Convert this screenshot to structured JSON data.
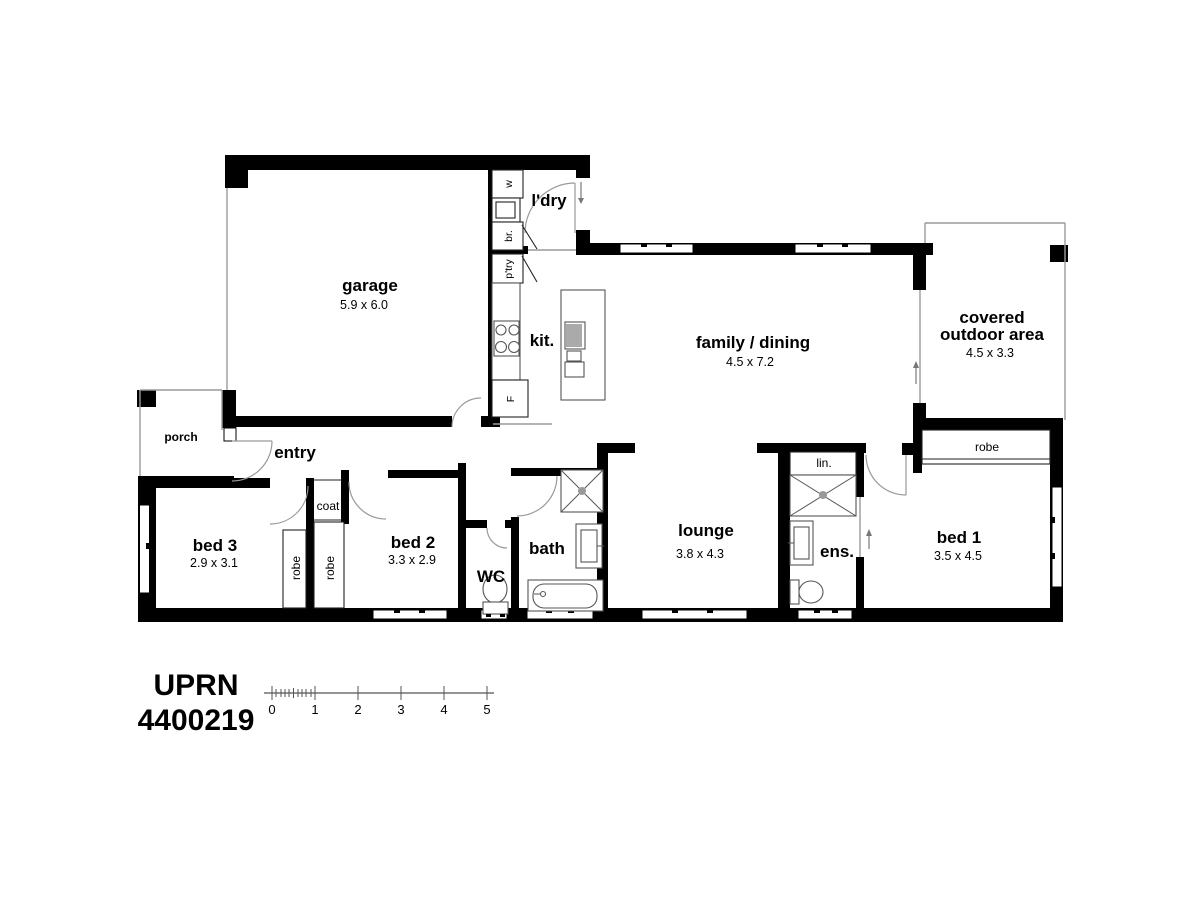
{
  "colors": {
    "ink": "#000000",
    "door_line": "#9a9a9a",
    "fixture_line": "#555555",
    "background": "#ffffff"
  },
  "rooms": {
    "garage": {
      "name": "garage",
      "dim": "5.9 x 6.0"
    },
    "laundry": {
      "name": "l'dry"
    },
    "kitchen": {
      "name": "kit."
    },
    "family_dining": {
      "name": "family / dining",
      "dim": "4.5 x 7.2"
    },
    "covered_outdoor": {
      "line1": "covered",
      "line2": "outdoor area",
      "dim": "4.5 x 3.3"
    },
    "porch": {
      "name": "porch"
    },
    "entry": {
      "name": "entry"
    },
    "bed1": {
      "name": "bed 1",
      "dim": "3.5 x 4.5"
    },
    "bed2": {
      "name": "bed 2",
      "dim": "3.3 x 2.9"
    },
    "bed3": {
      "name": "bed 3",
      "dim": "2.9 x 3.1"
    },
    "lounge": {
      "name": "lounge",
      "dim": "3.8 x 4.3"
    },
    "bath": {
      "name": "bath"
    },
    "wc": {
      "name": "WC"
    },
    "ensuite": {
      "name": "ens."
    },
    "linen": {
      "name": "lin."
    },
    "coat": {
      "name": "coat"
    },
    "robe_bed1": {
      "name": "robe"
    },
    "robe_bed2": {
      "name": "robe"
    },
    "robe_bed3": {
      "name": "robe"
    }
  },
  "appliances": {
    "washer": "w",
    "broom": "br.",
    "pantry": "p'try",
    "fridge": "F"
  },
  "title": {
    "line1": "UPRN",
    "line2": "4400219"
  },
  "scale_bar": {
    "ticks": [
      "0",
      "1",
      "2",
      "3",
      "4",
      "5"
    ]
  }
}
